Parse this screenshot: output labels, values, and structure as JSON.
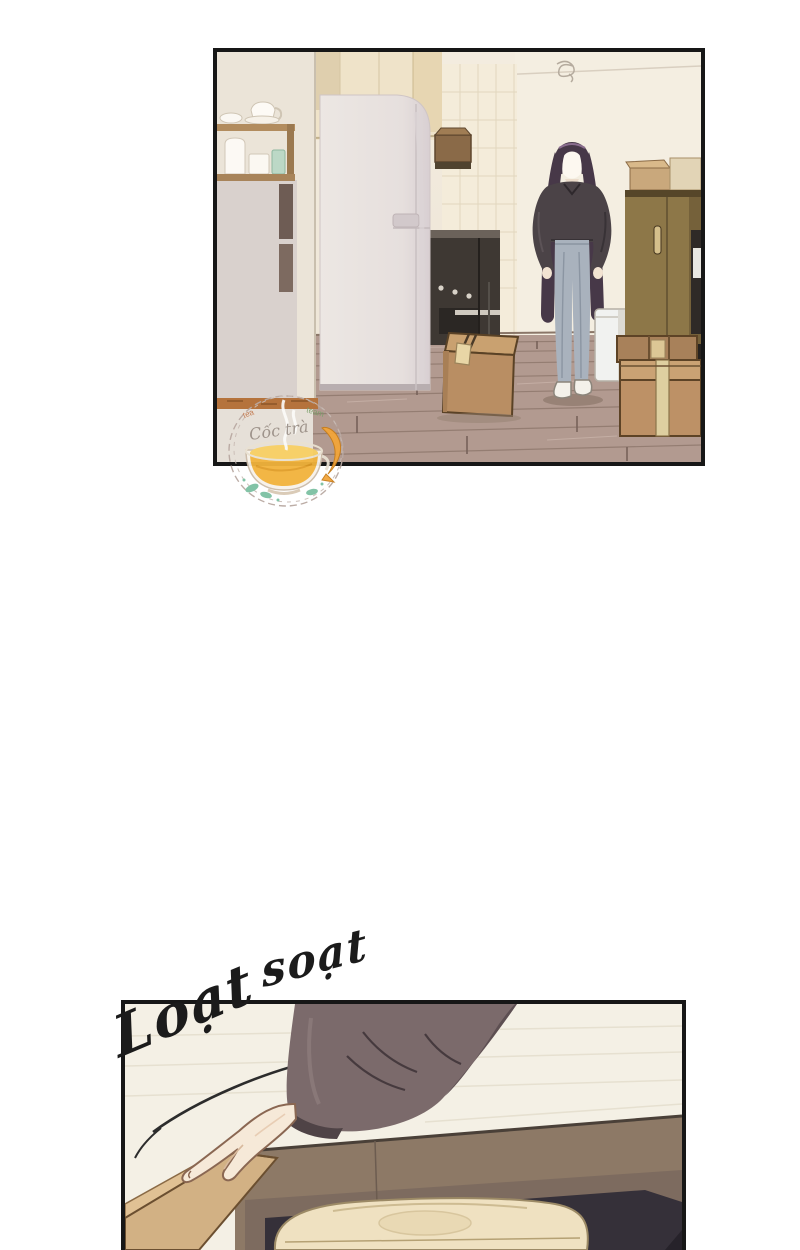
{
  "page": {
    "width": 800,
    "height": 1250,
    "background": "#ffffff"
  },
  "sfx": {
    "word1": "Loạt",
    "word2": "soạt",
    "color": "#1b1b1b"
  },
  "watermark": {
    "arc_text_left": "tea",
    "arc_text_right": "team",
    "script_text": "Cốc trà",
    "tea_color": "#f2b33c",
    "tea_surface_color": "#f8d064",
    "accent_fish_color": "#f2a53a",
    "leaf_color": "#7cc0a2"
  },
  "colors": {
    "panel_border": "#171717",
    "wall_cream": "#f1e9db",
    "wall_center": "#f4eee1",
    "tile_wall": "#f4ecda",
    "cabinet_cream": "#efe3c9",
    "shelf_wood": "#b28c5e",
    "baseboard_wood": "#b5733c",
    "fridge_body": "#eae4e1",
    "fridge_shade": "#d9d1d3",
    "stove_dark": "#3e3833",
    "hair": "#473848",
    "sweater": "#4b4347",
    "jeans": "#a9b2bd",
    "skin": "#f5e8d6",
    "shoes": "#f4f1ea",
    "trash_can": "#f1f2f0",
    "wardrobe": "#8d7748",
    "cardboard": "#bd9166",
    "cardboard_top": "#caa274",
    "tape_light": "#decfa0",
    "floor_wood": "#b29a90",
    "sleeve": "#7b6a6b",
    "sleeve_shadow": "#5d4f52",
    "box_inner_wall": "#8d7966",
    "box_flap": "#d2b184",
    "box_interior_dark": "#353039",
    "cloth": "#efe1c1",
    "closeup_bg": "#f4f0e5"
  }
}
